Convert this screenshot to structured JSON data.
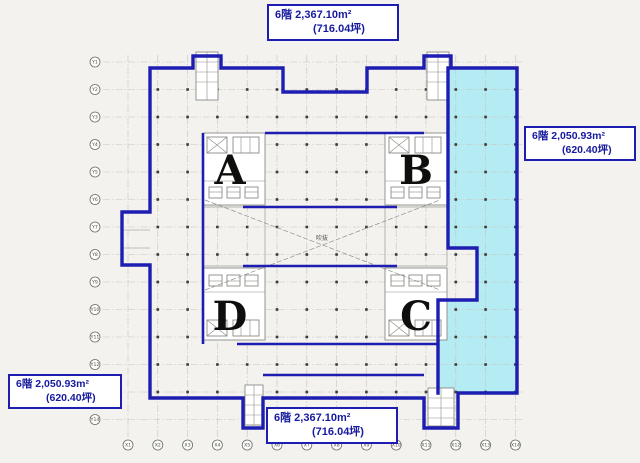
{
  "drawing": {
    "kind": "office-floor-plan",
    "floor": "6階"
  },
  "colors": {
    "outline_blue": "#1d1db2",
    "highlight_cyan": "#aeeaf2",
    "label_text": "#161a9e",
    "grid": "#c7c3b9"
  },
  "area_labels": {
    "top": {
      "line1": "6階  2,367.10m²",
      "line2": "(716.04坪)"
    },
    "right": {
      "line1": "6階  2,050.93m²",
      "line2": "(620.40坪)"
    },
    "bottom_left": {
      "line1": "6階  2,050.93m²",
      "line2": "(620.40坪)"
    },
    "bottom_center": {
      "line1": "6階  2,367.10m²",
      "line2": "(716.04坪)"
    }
  },
  "cores": {
    "a": "A",
    "b": "B",
    "c": "C",
    "d": "D"
  },
  "atrium_note": "吹抜",
  "axes": {
    "left": [
      "Y1",
      "Y2",
      "Y3",
      "Y4",
      "Y5",
      "Y6",
      "Y7",
      "Y8",
      "Y9",
      "Y10",
      "Y11",
      "Y12",
      "Y13",
      "Y14"
    ],
    "bottom": [
      "X1",
      "X2",
      "X3",
      "X4",
      "X5",
      "X6",
      "X7",
      "X8",
      "X9",
      "X10",
      "X11",
      "X12",
      "X13",
      "X14"
    ]
  }
}
